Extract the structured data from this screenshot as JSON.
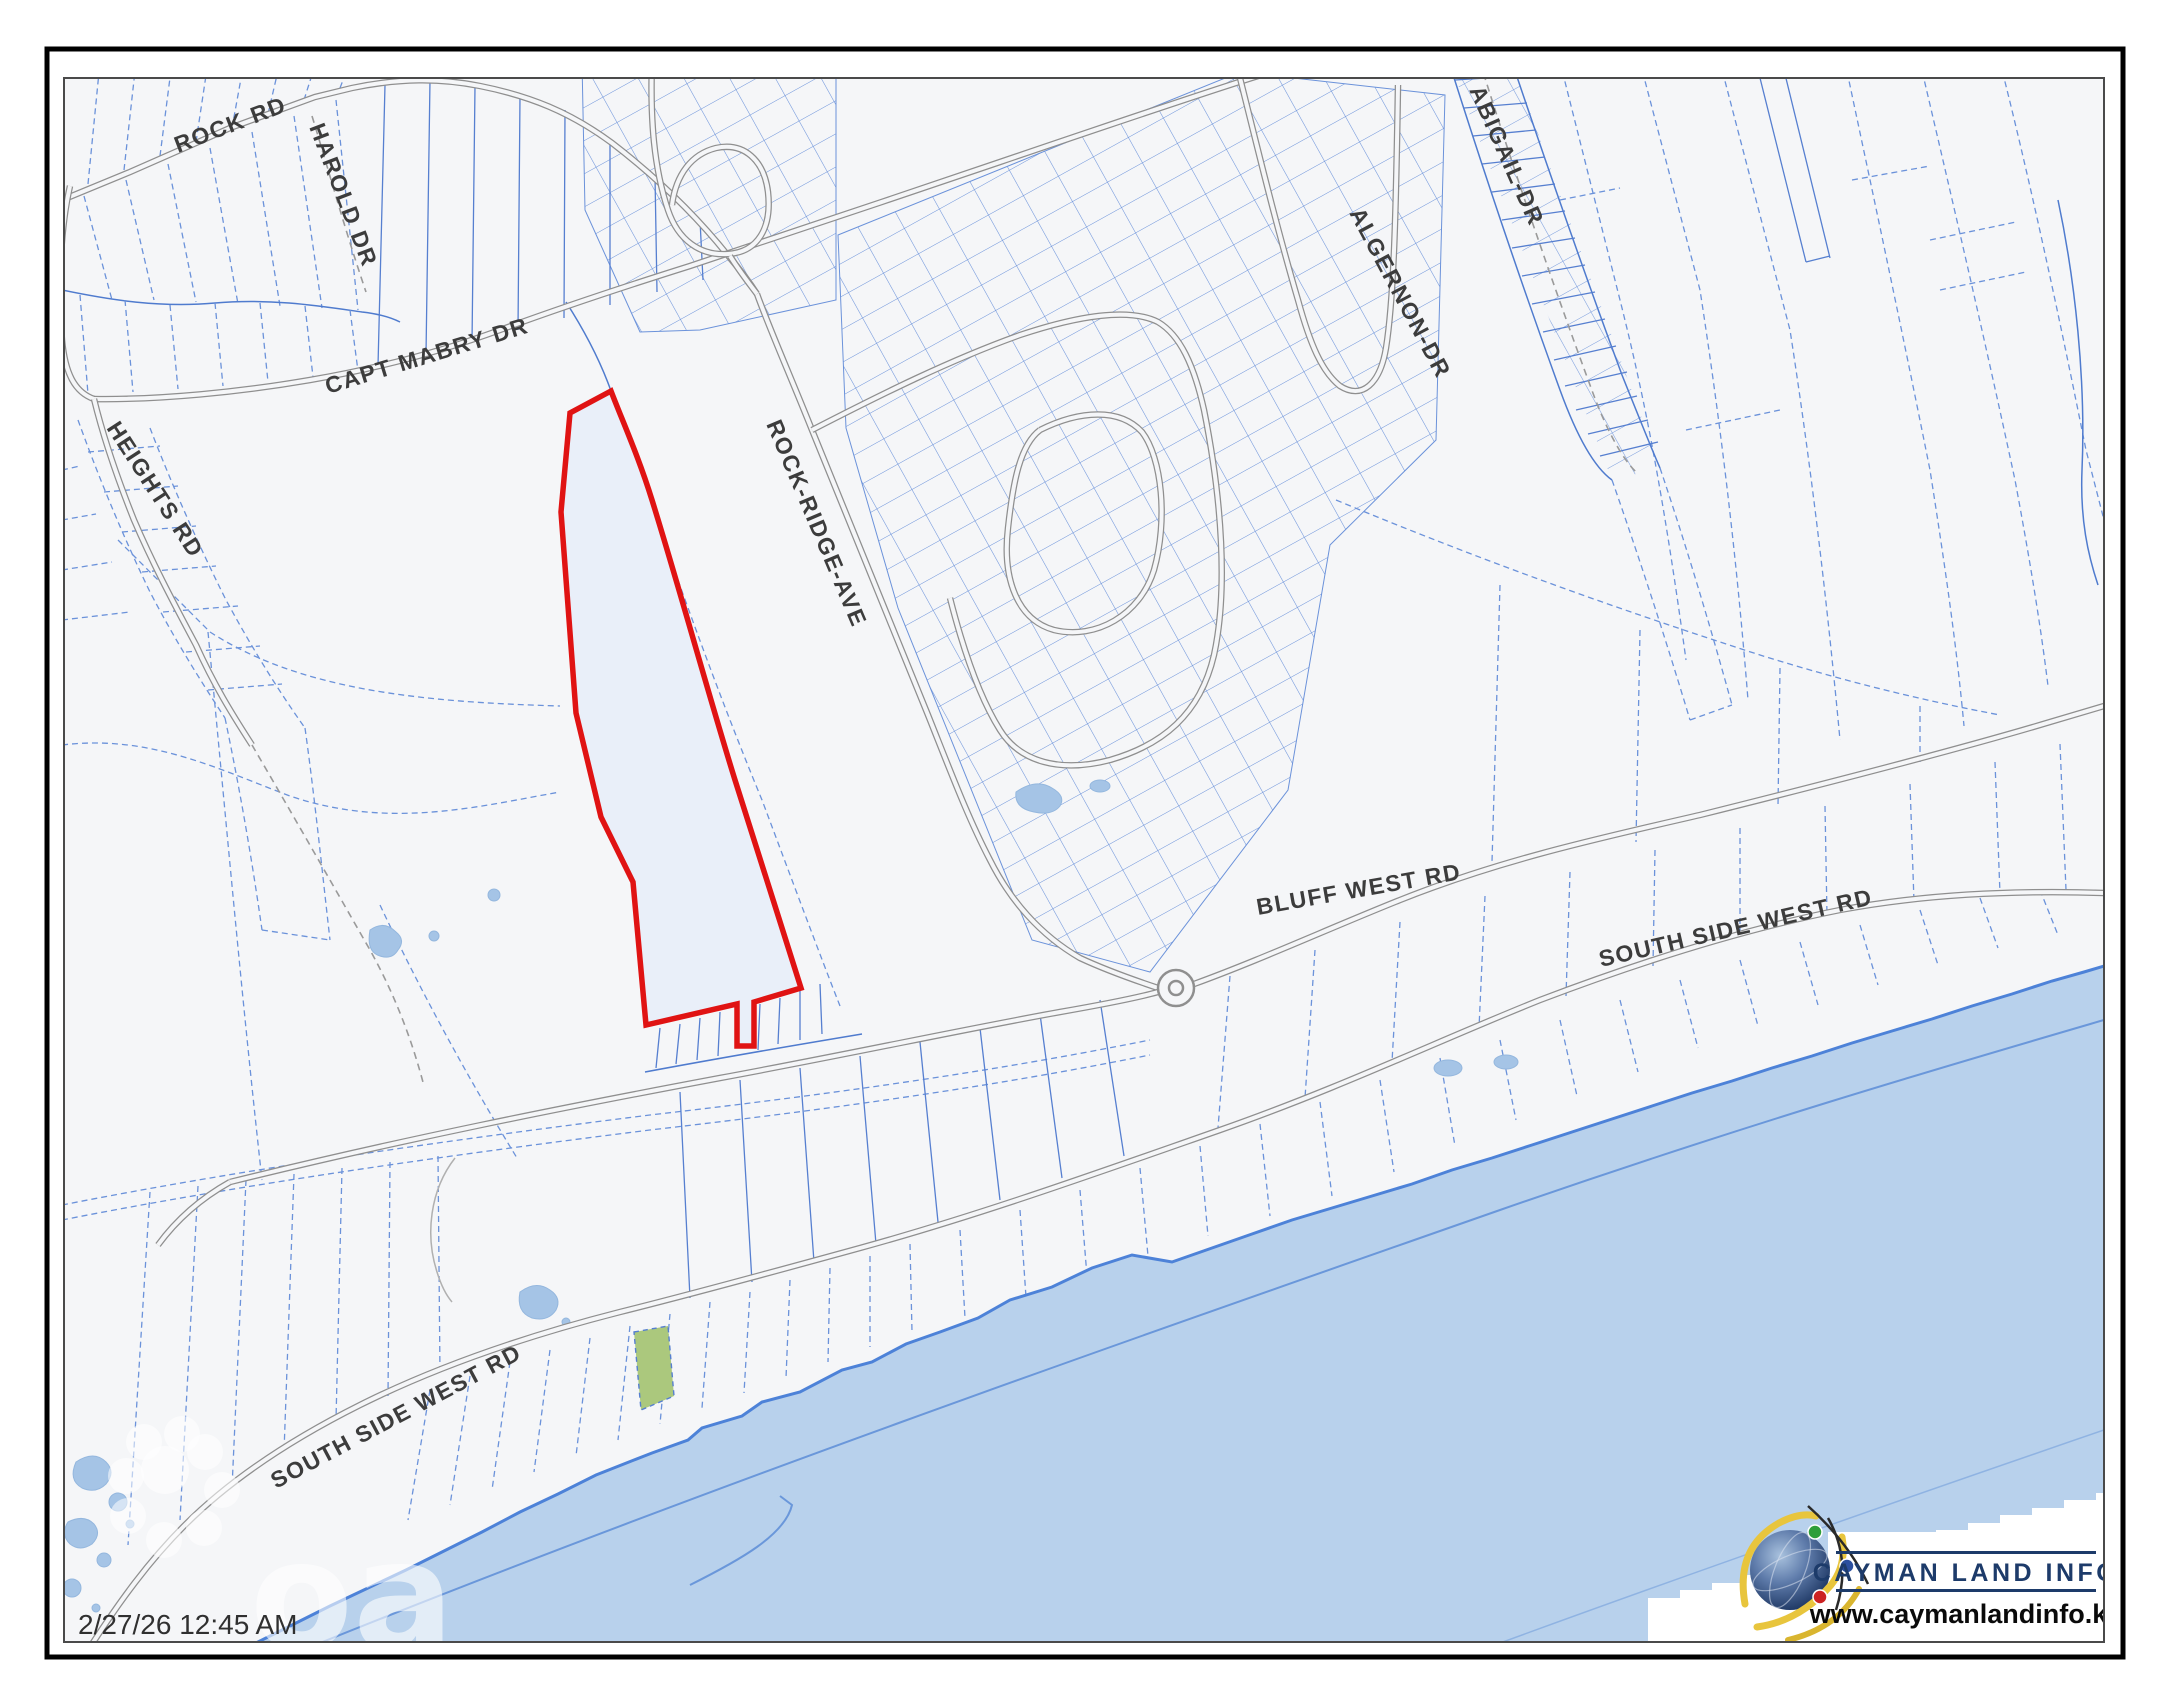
{
  "map": {
    "timestamp": "2/27/26 12:45 AM",
    "watermark": "oa",
    "road_labels": {
      "rock_rd": "ROCK RD",
      "harold_dr": "HAROLD DR",
      "capt_mabry_dr": "CAPT MABRY DR",
      "heights_rd": "HEIGHTS RD",
      "rock_ridge_ave": "ROCK-RIDGE-AVE",
      "algernon_dr": "ALGERNON-DR",
      "abigail_dr": "ABIGAIL-DR",
      "bluff_west_rd": "BLUFF WEST RD",
      "south_side_west_rd_east": "SOUTH SIDE WEST RD",
      "south_side_west_rd_west": "SOUTH SIDE WEST RD"
    },
    "colors": {
      "highlight_parcel_outline": "#e01313",
      "highlight_parcel_fill": "#e9eff9",
      "green_parcel_fill": "#abc87d",
      "parcel_line_blue": "#567fd0",
      "road_gray": "#8f8f8f",
      "water_fill": "#b8d1ec",
      "coast_line": "#4d82d8",
      "land_fill": "#f5f6f8",
      "label_gray": "#3c3c3c"
    }
  },
  "logo": {
    "title": "CAYMAN LAND INFO",
    "url": "www.caymanlandinfo.ky",
    "navy": "#1d3b6a"
  }
}
